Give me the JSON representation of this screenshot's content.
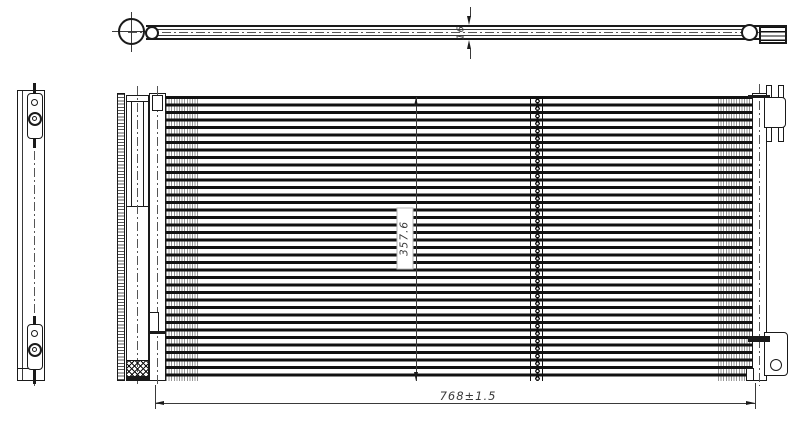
{
  "drawing": {
    "type": "technical-orthographic-drawing",
    "subject": "automotive condenser with receiver drier and inlet pipe",
    "colors": {
      "background": "#ffffff",
      "line": "#1a1a1a",
      "dimension": "#3a3a3a"
    },
    "dimensions": {
      "pipe_diameter": "16",
      "core_height": "357.6",
      "overall_width": "768±1.5"
    }
  }
}
